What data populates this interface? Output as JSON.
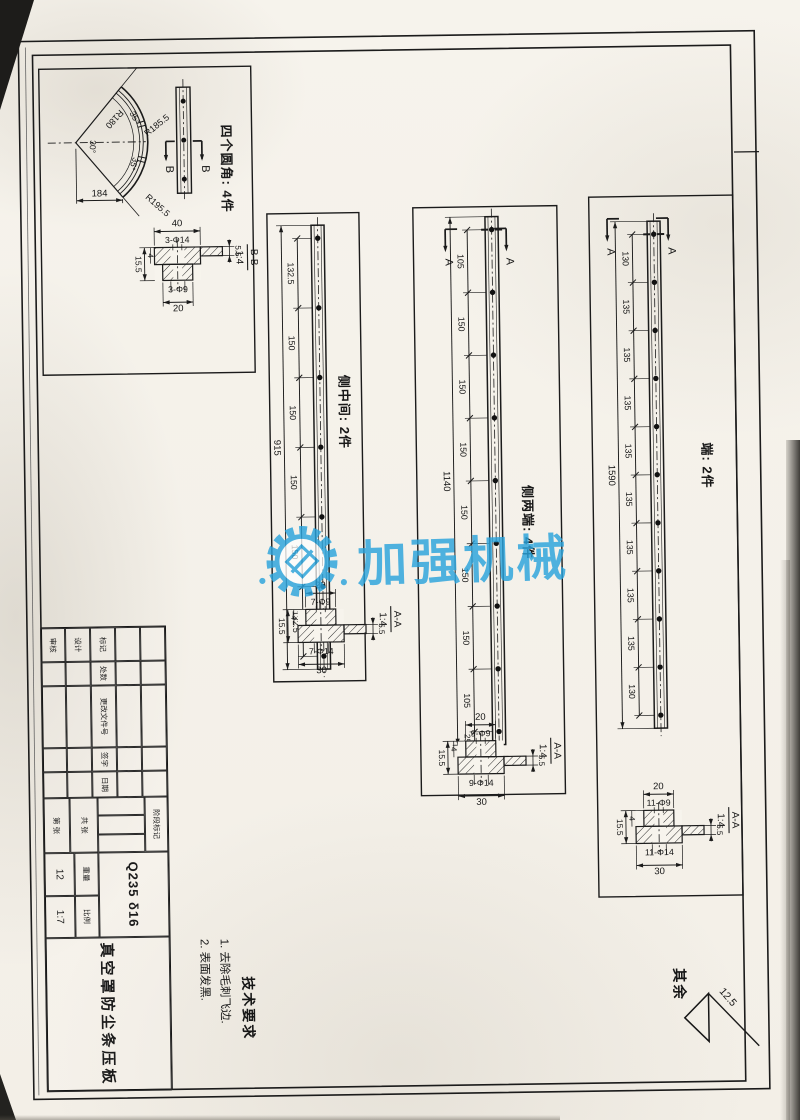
{
  "watermark": {
    "text": "加强机械",
    "color": "#2aa3dc",
    "logo": "gear-diamond"
  },
  "fan_view": {
    "label": "四个圆角: 4件",
    "dims": {
      "radius_inner": "R180",
      "radius_mid": "R185.5",
      "radius_outer": "R195.5",
      "angle_left": "35°",
      "angle_center": "30°",
      "angle_right": "35°",
      "width": "184"
    },
    "section_letter": "B",
    "section": {
      "name": "B-B",
      "scale": "1:4",
      "dim_top": "40",
      "holes_top": "3-Φ14",
      "holes_bottom": "3-Φ9",
      "dim_bottom": "20",
      "thickness_total": "15.5",
      "step": "4",
      "flange": "5.5"
    }
  },
  "strips": [
    {
      "label": "侧中间: 2件",
      "overall": "915",
      "gaps": [
        "132.5",
        "150",
        "150",
        "150",
        "150",
        "132.5"
      ],
      "end_gap": null,
      "hole_count": 7,
      "section_letter": null,
      "section": {
        "name": "A-A",
        "scale": "1:4",
        "dim_top": "20",
        "holes_top": "7-Φ9",
        "holes_bottom": "7-Φ14",
        "dim_bottom": "30",
        "thickness_total": "15.5",
        "step": "4",
        "flange": "5.5"
      }
    },
    {
      "label": "侧两端: 4件",
      "overall": "1140",
      "gaps": [
        "105",
        "150",
        "150",
        "150",
        "150",
        "150",
        "150",
        "105"
      ],
      "end_gap": "25",
      "hole_count": 9,
      "section_letter": "A",
      "section": {
        "name": "A-A",
        "scale": "1:4",
        "dim_top": "20",
        "holes_top": "9-Φ9",
        "holes_bottom": "9-Φ14",
        "dim_bottom": "30",
        "thickness_total": "15.5",
        "step": "4",
        "flange": "5.5"
      }
    },
    {
      "label": "端: 2件",
      "overall": "1590",
      "gaps": [
        "130",
        "135",
        "135",
        "135",
        "135",
        "135",
        "135",
        "135",
        "135",
        "130"
      ],
      "end_gap": null,
      "hole_count": 11,
      "section_letter": "A",
      "section": {
        "name": "A-A",
        "scale": "1:4",
        "dim_top": "20",
        "holes_top": "11-Φ9",
        "holes_bottom": "11-Φ14",
        "dim_bottom": "30",
        "thickness_total": "15.5",
        "step": "4",
        "flange": "5.5"
      }
    }
  ],
  "title_block": {
    "material": "Q235 δ16",
    "part_name": "真空罩防尘条压板",
    "revision_headers": [
      "标记",
      "处数",
      "更改文件号",
      "签字",
      "日期"
    ],
    "signature_rows": [
      "设计",
      "审核"
    ],
    "stage_label": "阶段标记",
    "weight_label": "重量",
    "weight_value": "12",
    "scale_label": "比例",
    "scale_value": "1:7",
    "sheet_total": "共 张",
    "sheet_number": "第 张"
  },
  "tech_requirements": {
    "title": "技术要求",
    "items": [
      "1. 去除毛刺飞边.",
      "2. 表面发黑."
    ]
  },
  "surface_note": {
    "label": "其余",
    "roughness": "12.5"
  }
}
